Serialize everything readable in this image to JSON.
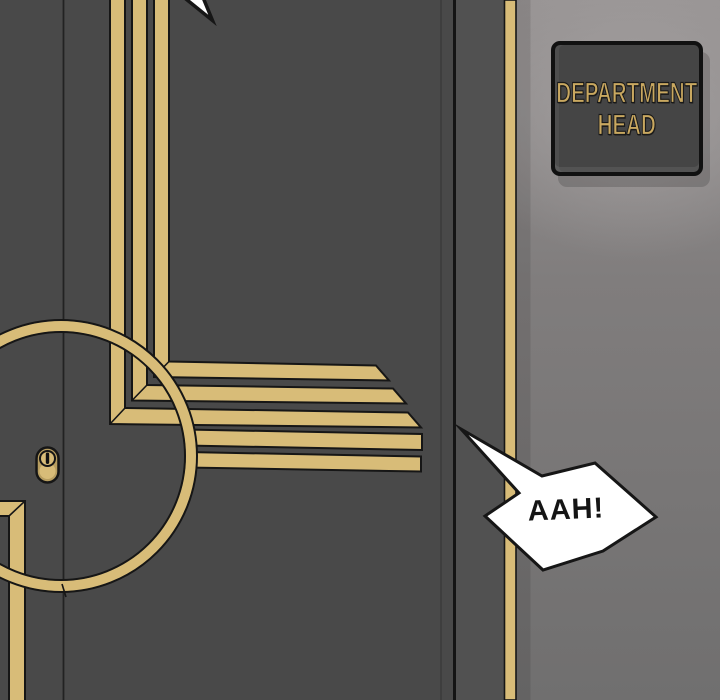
{
  "panel": {
    "sign": {
      "line1": "DEPARTMENT",
      "line2": "HEAD"
    },
    "speech_bubble": {
      "text": "AAH!"
    }
  },
  "colors": {
    "door": "#494949",
    "door_frame": "#515151",
    "door_line": "#222222",
    "door_edge": "#141414",
    "gold": "#d8bc78",
    "gold_deep": "#b89e60",
    "outline": "#161616",
    "wall_top": "#989494",
    "wall_mid": "#807d7d",
    "wall_bottom": "#706f6f",
    "wall_light": "#a5a1a1",
    "sign_plate": "#454545",
    "sign_border": "#111111",
    "sign_text": "#c9a860",
    "bubble_fill": "#ffffff",
    "bubble_text": "#151515"
  }
}
